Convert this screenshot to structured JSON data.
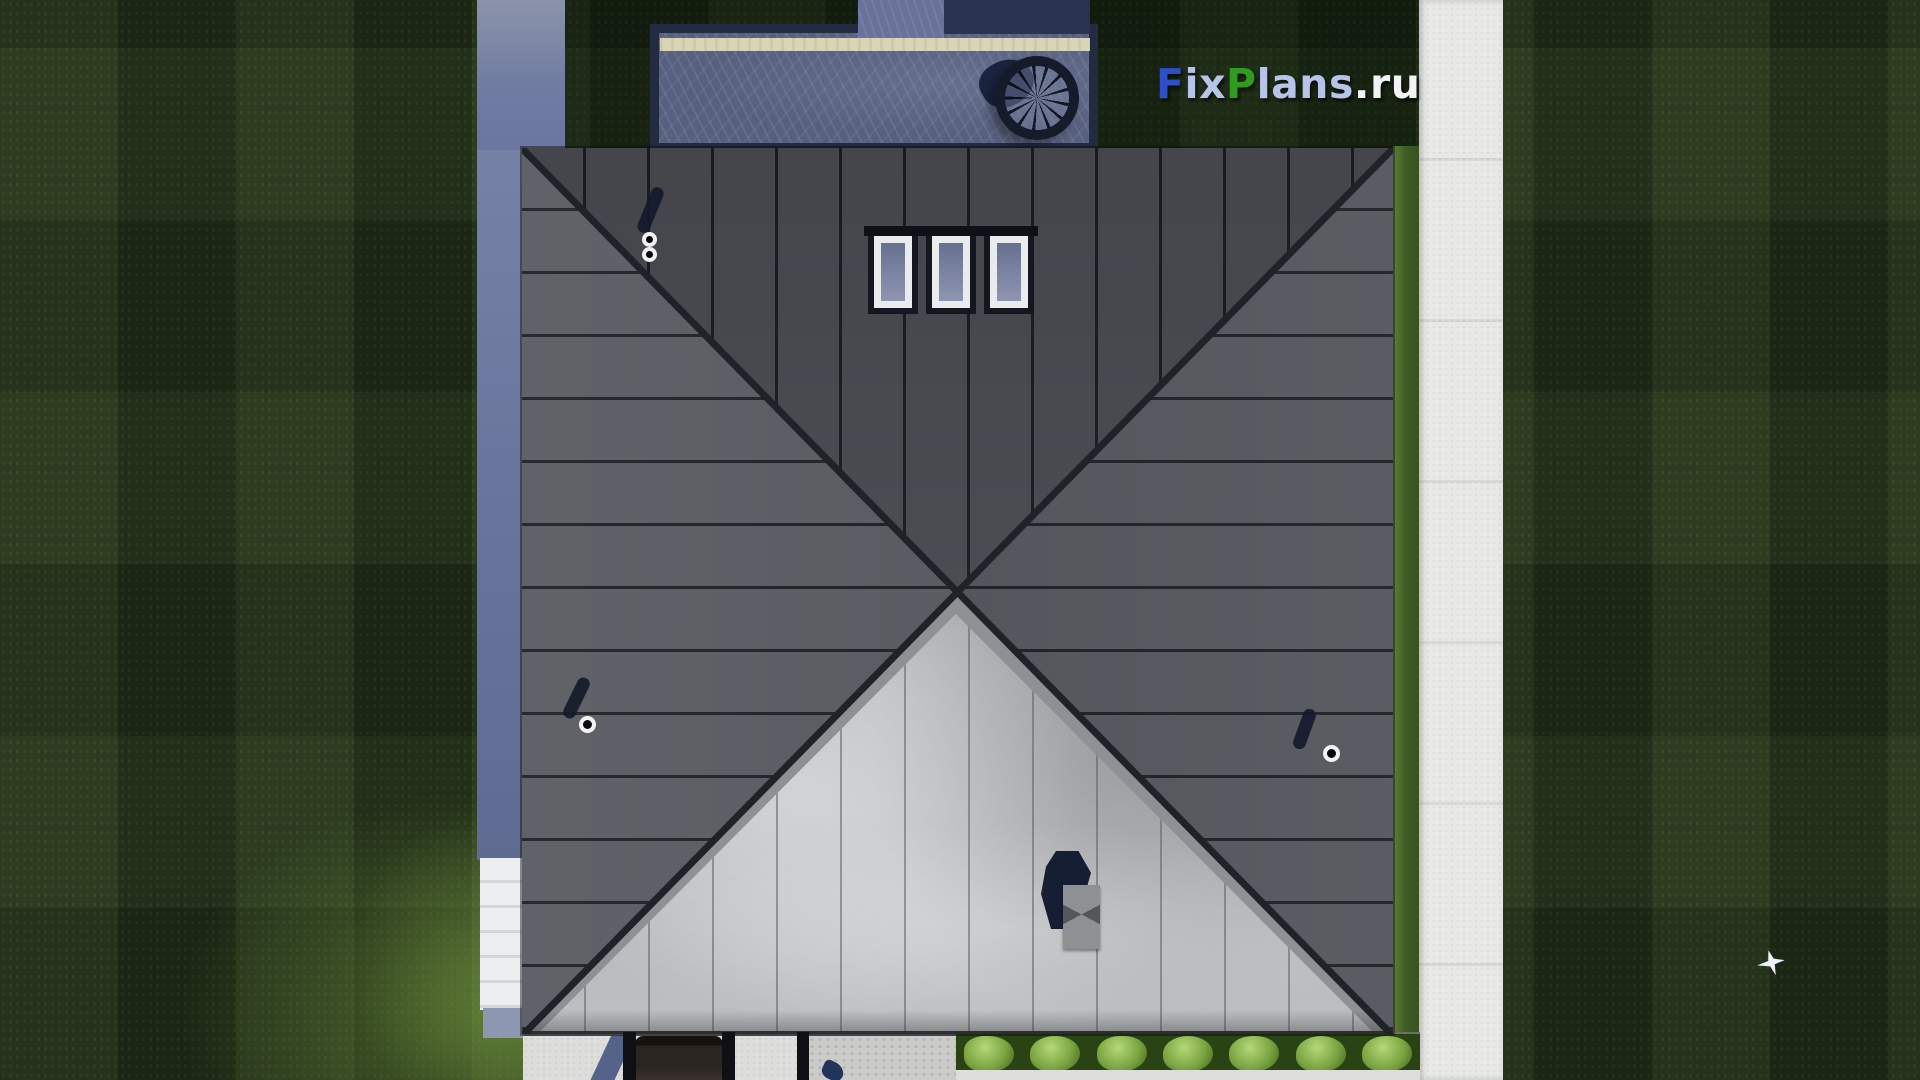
{
  "watermark": {
    "full_text": "FixPlans.ru",
    "segments": [
      {
        "text": "F",
        "color": "#2d4fc8"
      },
      {
        "text": "ix",
        "color": "#b7c4ea"
      },
      {
        "text": "P",
        "color": "#2f9c1f"
      },
      {
        "text": "lans",
        "color": "#b7c4ea"
      },
      {
        "text": ".ru",
        "color": "#f2f3f5"
      }
    ]
  },
  "scene": {
    "description": "Top-down 3D architectural render of a house hip roof with lawn, side paths, terrace, driveway and hedge",
    "skylights": {
      "count": 3
    },
    "roof_vents": {
      "count": 3
    },
    "hedge_bushes": {
      "count": 7
    },
    "colors": {
      "lawn": "#22301a",
      "roof_rear_slope": "#4d4f56",
      "roof_left_slope": "#5a5c63",
      "roof_right_slope": "#54565d",
      "roof_front_slope": "#afb1b4",
      "hip_line": "#1f2229",
      "walkway": "#e8e9e7",
      "side_path": "#6e7aa0",
      "terrace_stone": "#57617f",
      "terrace_bench": "#d9d5b7",
      "hedge": "#2a4315",
      "bush_highlight": "#b5d877",
      "chimney_shadow": "#151e33",
      "chimney_cap": "#8e9093"
    }
  }
}
